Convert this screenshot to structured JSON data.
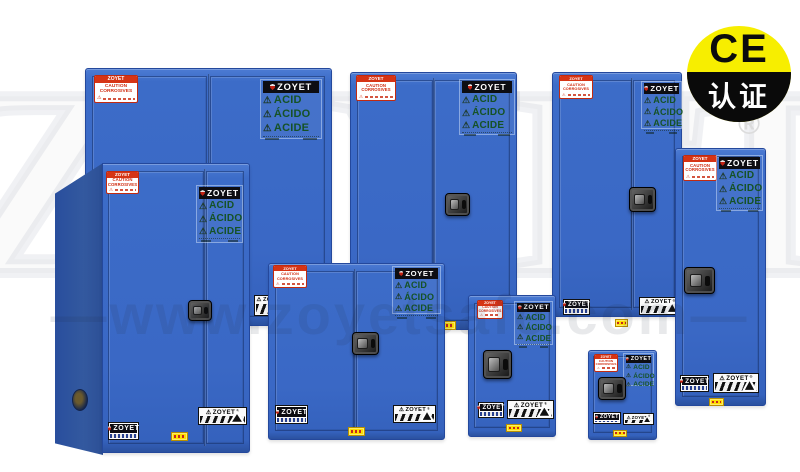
{
  "scene": {
    "description": "Product collage of eight blue ZOYET corrosive (acid) storage safety cabinets on white background",
    "cabinet_count": 8,
    "cabinets": [
      {
        "position": "back-left",
        "doors": 2
      },
      {
        "position": "back-middle",
        "doors": 2
      },
      {
        "position": "back-right",
        "doors": 2
      },
      {
        "position": "tall-right",
        "doors": 1
      },
      {
        "position": "front-left-tall",
        "doors": 2
      },
      {
        "position": "front-middle",
        "doors": 2
      },
      {
        "position": "front-small",
        "doors": 1
      },
      {
        "position": "front-smallest",
        "doors": 1
      }
    ]
  },
  "ce_badge": {
    "top_text": "CE",
    "bottom_text": "认证",
    "circle_color": "#f7ee00",
    "band_color": "#0a0a0a"
  },
  "registered_mark": "®",
  "watermarks": {
    "website": "—www.zoyetsafe.com—",
    "brand_outline": "ZOYET"
  },
  "cabinet_labels": {
    "brand": "ZOYET",
    "acid_label": {
      "brand": "ZOYET",
      "warn_icon": "⚠",
      "lines": [
        "ACID",
        "ÁCIDO",
        "ACIDE"
      ],
      "text_color": "#1a5a2a"
    },
    "caution_label": {
      "brand": "ZOYET",
      "line1": "CAUTION",
      "line2": "CORROSIVES"
    },
    "stripe_label": {
      "warn_icon": "⚠",
      "brand": "ZOYET",
      "reg": "®"
    }
  },
  "colors": {
    "cabinet_blue": "#3a68c5",
    "cabinet_blue_dark": "#2b519f",
    "label_green": "#155226",
    "label_red": "#d63415",
    "sticker_yellow": "#ffdf00",
    "background": "#ffffff"
  }
}
